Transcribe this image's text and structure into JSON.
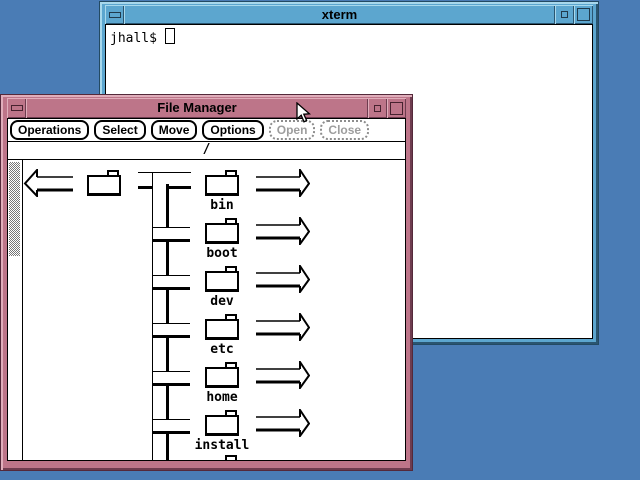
{
  "colors": {
    "desktop_background": "#4a7cb5",
    "fm_frame": "#bd7589",
    "fm_frame_light": "#e0aebb",
    "fm_frame_dark": "#6e3c4f",
    "xterm_frame": "#5ca6cf",
    "xterm_frame_light": "#a8d8ec",
    "xterm_frame_dark": "#2a5570",
    "client_background": "#ffffff",
    "line_color": "#000000",
    "disabled_text": "#9d9d9d"
  },
  "xterm": {
    "title": "xterm",
    "prompt": "jhall$"
  },
  "file_manager": {
    "title": "File Manager",
    "path": "/",
    "menu": [
      {
        "label": "Operations",
        "enabled": true
      },
      {
        "label": "Select",
        "enabled": true
      },
      {
        "label": "Move",
        "enabled": true
      },
      {
        "label": "Options",
        "enabled": true
      },
      {
        "label": "Open",
        "enabled": false
      },
      {
        "label": "Close",
        "enabled": false
      }
    ],
    "folders": [
      "bin",
      "boot",
      "dev",
      "etc",
      "home",
      "install"
    ]
  }
}
